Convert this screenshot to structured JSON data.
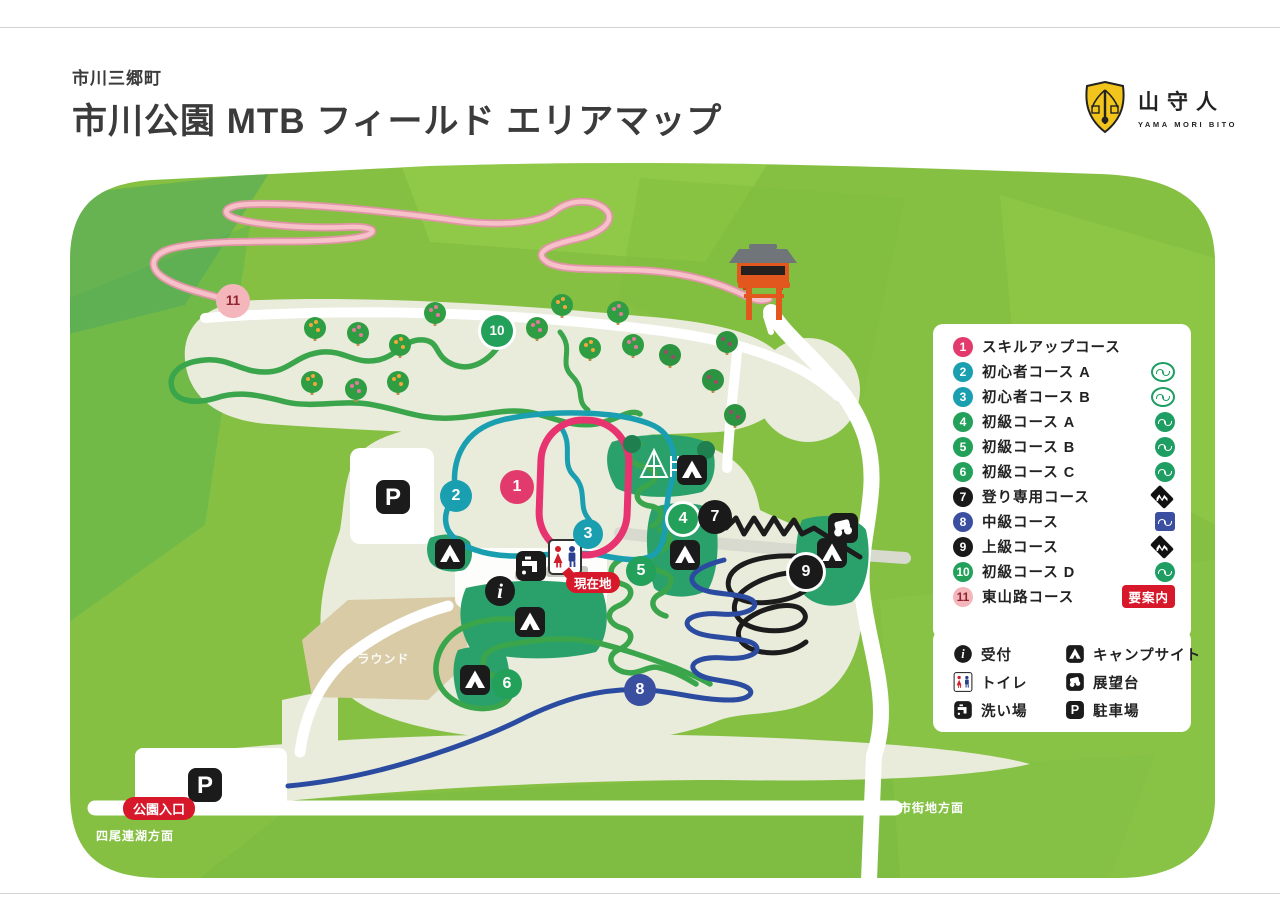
{
  "page": {
    "municipality": "市川三郷町",
    "title": "市川公園 MTB フィールド エリアマップ"
  },
  "logo": {
    "kanji": "山守人",
    "romaji": "YAMA MORI BITO",
    "shield_color": "#f2c51d"
  },
  "course_legend": {
    "items": [
      {
        "num": "1",
        "label": "スキルアップコース",
        "color": "#e23a6d",
        "text": "#ffffff",
        "icon": "none"
      },
      {
        "num": "2",
        "label": "初心者コース A",
        "color": "#1a9fb0",
        "text": "#ffffff",
        "icon": "open-circle-wave"
      },
      {
        "num": "3",
        "label": "初心者コース B",
        "color": "#1a9fb0",
        "text": "#ffffff",
        "icon": "open-circle-wave"
      },
      {
        "num": "4",
        "label": "初級コース A",
        "color": "#23a05a",
        "text": "#ffffff",
        "icon": "filled-circle-wave"
      },
      {
        "num": "5",
        "label": "初級コース B",
        "color": "#23a05a",
        "text": "#ffffff",
        "icon": "filled-circle-wave"
      },
      {
        "num": "6",
        "label": "初級コース C",
        "color": "#23a05a",
        "text": "#ffffff",
        "icon": "filled-circle-wave"
      },
      {
        "num": "7",
        "label": "登り専用コース",
        "color": "#1a1a1a",
        "text": "#ffffff",
        "icon": "black-diamond-zigzag"
      },
      {
        "num": "8",
        "label": "中級コース",
        "color": "#3a4fa0",
        "text": "#ffffff",
        "icon": "blue-square-wave"
      },
      {
        "num": "9",
        "label": "上級コース",
        "color": "#1a1a1a",
        "text": "#ffffff",
        "icon": "black-diamond-zigzag"
      },
      {
        "num": "10",
        "label": "初級コース D",
        "color": "#23a05a",
        "text": "#ffffff",
        "icon": "filled-circle-wave"
      },
      {
        "num": "11",
        "label": "東山路コース",
        "color": "#f4b6ba",
        "text": "#8f2430",
        "icon": "guide-badge",
        "badge": "要案内",
        "badge_color": "#d7182a"
      }
    ]
  },
  "facility_legend": {
    "items": [
      {
        "icon": "info-icon",
        "label": "受付"
      },
      {
        "icon": "toilet-icon",
        "label": "トイレ"
      },
      {
        "icon": "wash-icon",
        "label": "洗い場"
      },
      {
        "icon": "tent-icon",
        "label": "キャンプサイト"
      },
      {
        "icon": "observation-icon",
        "label": "展望台"
      },
      {
        "icon": "parking-icon",
        "label": "駐車場"
      }
    ]
  },
  "map_labels": {
    "current_location": "現在地",
    "park_entrance": "公園入口",
    "ground": "グラウンド",
    "to_lake": "四尾連湖方面",
    "to_city": "市街地方面"
  },
  "icons": {
    "parking_glyph": "P",
    "info_glyph": "i"
  },
  "colors": {
    "badge_red": "#d7182a",
    "map_green": "#85c043",
    "cleared_land": "#e9ebdb",
    "camp_green": "#2aa06b",
    "trail_green": "#3aa54b",
    "trail_teal": "#1a9fb0",
    "trail_pink": "#e73370",
    "trail_light_pink": "#f3b0bb",
    "trail_blue": "#2b4ba0",
    "trail_black": "#1c1c1c"
  }
}
